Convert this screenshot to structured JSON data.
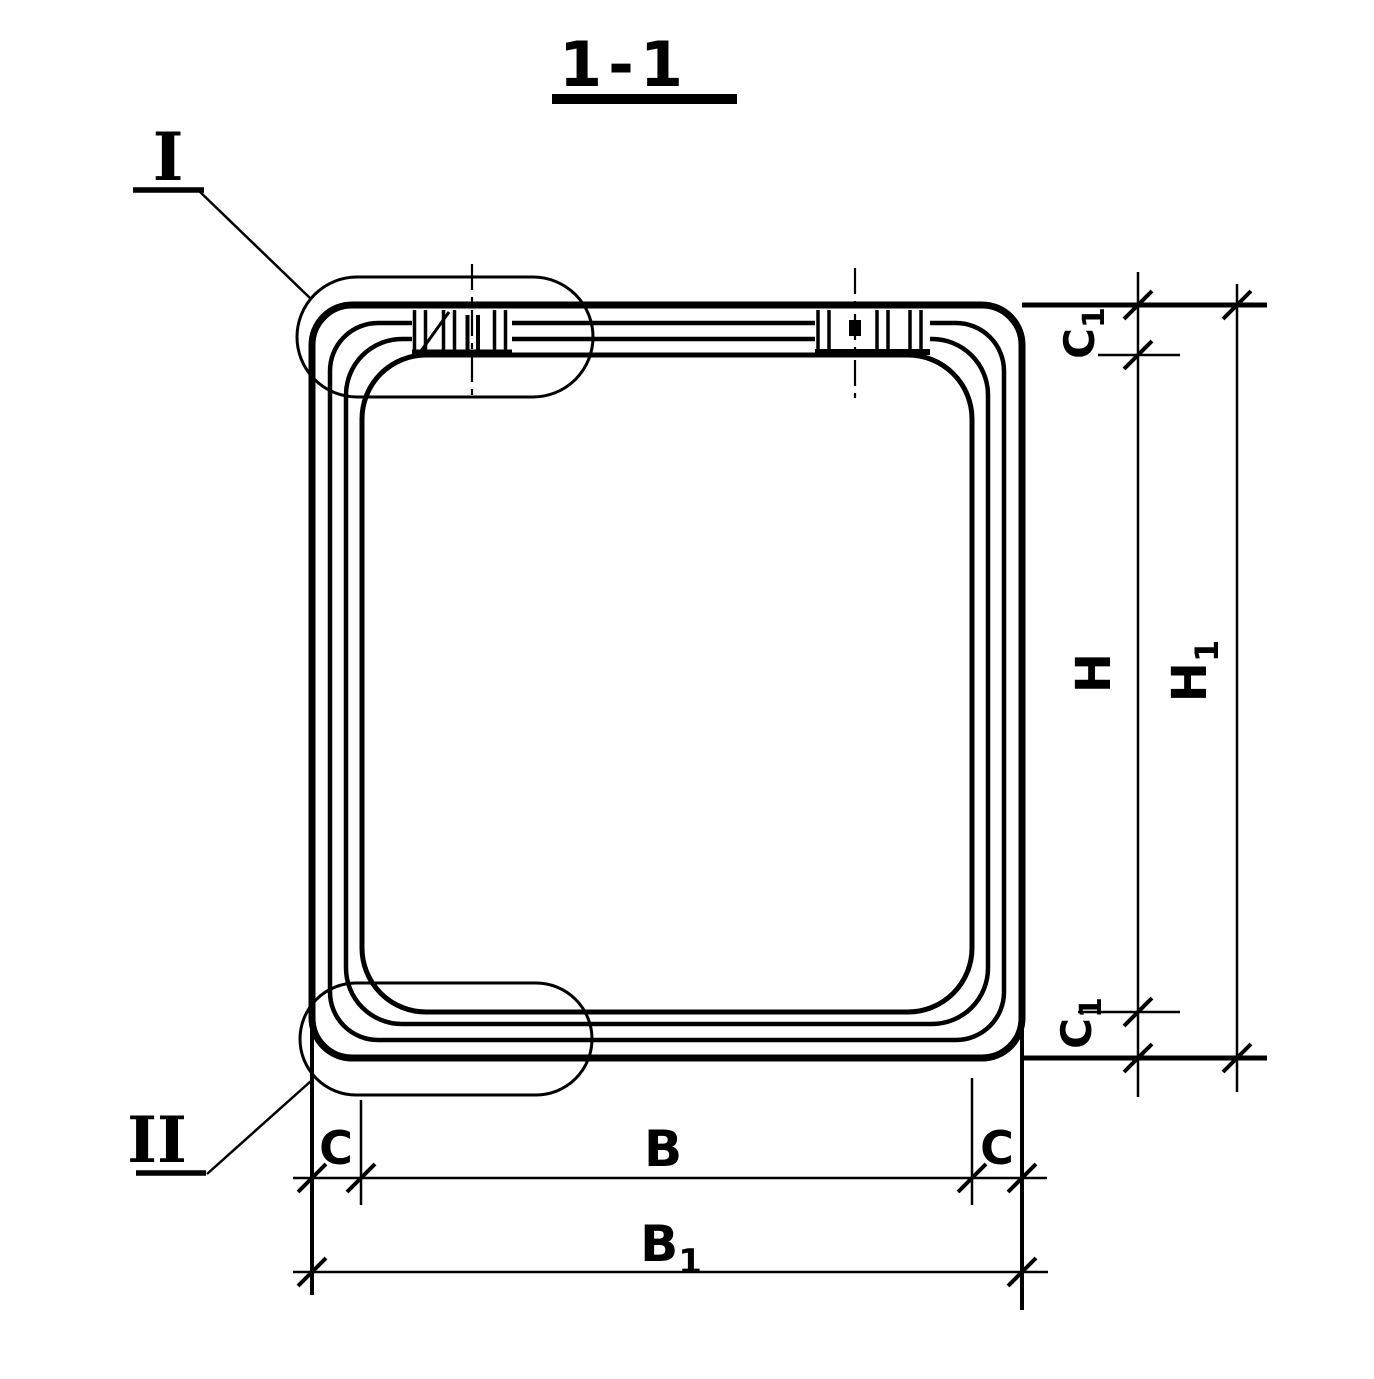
{
  "colors": {
    "ink": "#000000",
    "paper": "#ffffff"
  },
  "title": {
    "label": "1-1"
  },
  "callouts": {
    "top": {
      "label": "I"
    },
    "bottom": {
      "label": "II"
    }
  },
  "dims": {
    "c1_top": {
      "main": "C",
      "sub": "1"
    },
    "h": {
      "main": "H"
    },
    "h1": {
      "main": "H",
      "sub": "1"
    },
    "c1_bottom": {
      "main": "C",
      "sub": "1"
    },
    "c_left": {
      "main": "C"
    },
    "b": {
      "main": "B"
    },
    "c_right": {
      "main": "C"
    },
    "b1": {
      "main": "B",
      "sub": "1"
    }
  }
}
